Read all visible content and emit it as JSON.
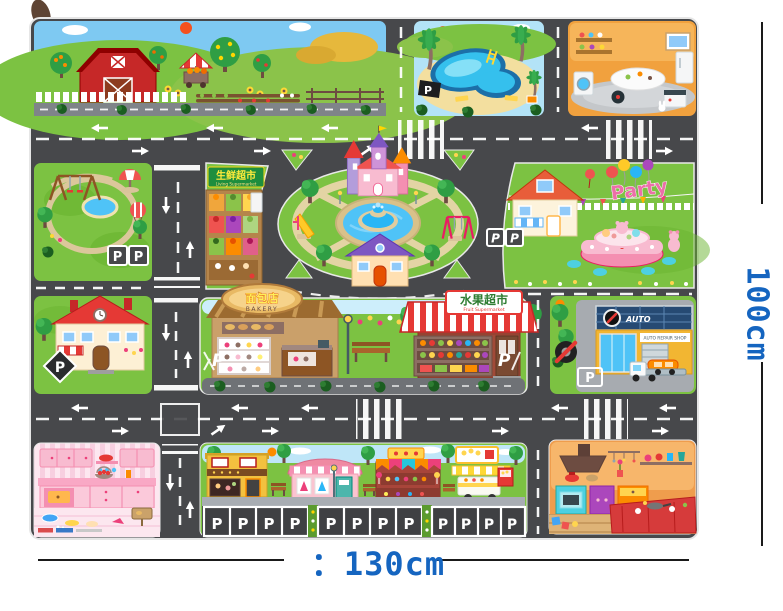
{
  "annotation": {
    "width_label": "：130cm",
    "height_label": "100cm"
  },
  "mat": {
    "signs": {
      "fresh_market_cn": "生鲜超市",
      "fresh_market_en": "Living Supermarket",
      "bakery_cn": "面包店",
      "bakery_en": "BAKERY",
      "fruit_market_cn": "水果超市",
      "fruit_market_en": "Fruit Supermarket",
      "party": "Party",
      "auto_logo": "AUTO",
      "auto_banner": "AUTO REPAIR SHOP"
    },
    "parking_letter": "P",
    "scene_names": [
      "farm",
      "swimming-pool",
      "home-kitchen",
      "playground-park",
      "fresh-market-stand",
      "castle-roundabout-fountain",
      "party-lawn",
      "school-house",
      "bakery",
      "fruit-supermarket",
      "auto-repair-shop",
      "pink-kitchen",
      "street-shops",
      "orange-kitchen",
      "parking-stalls"
    ]
  },
  "colors": {
    "dimension_blue": "#1565c0",
    "road_gray": "#47484b",
    "grass_green": "#7cc242",
    "pool_blue": "#35c0ed",
    "awning_red": "#e53935"
  }
}
